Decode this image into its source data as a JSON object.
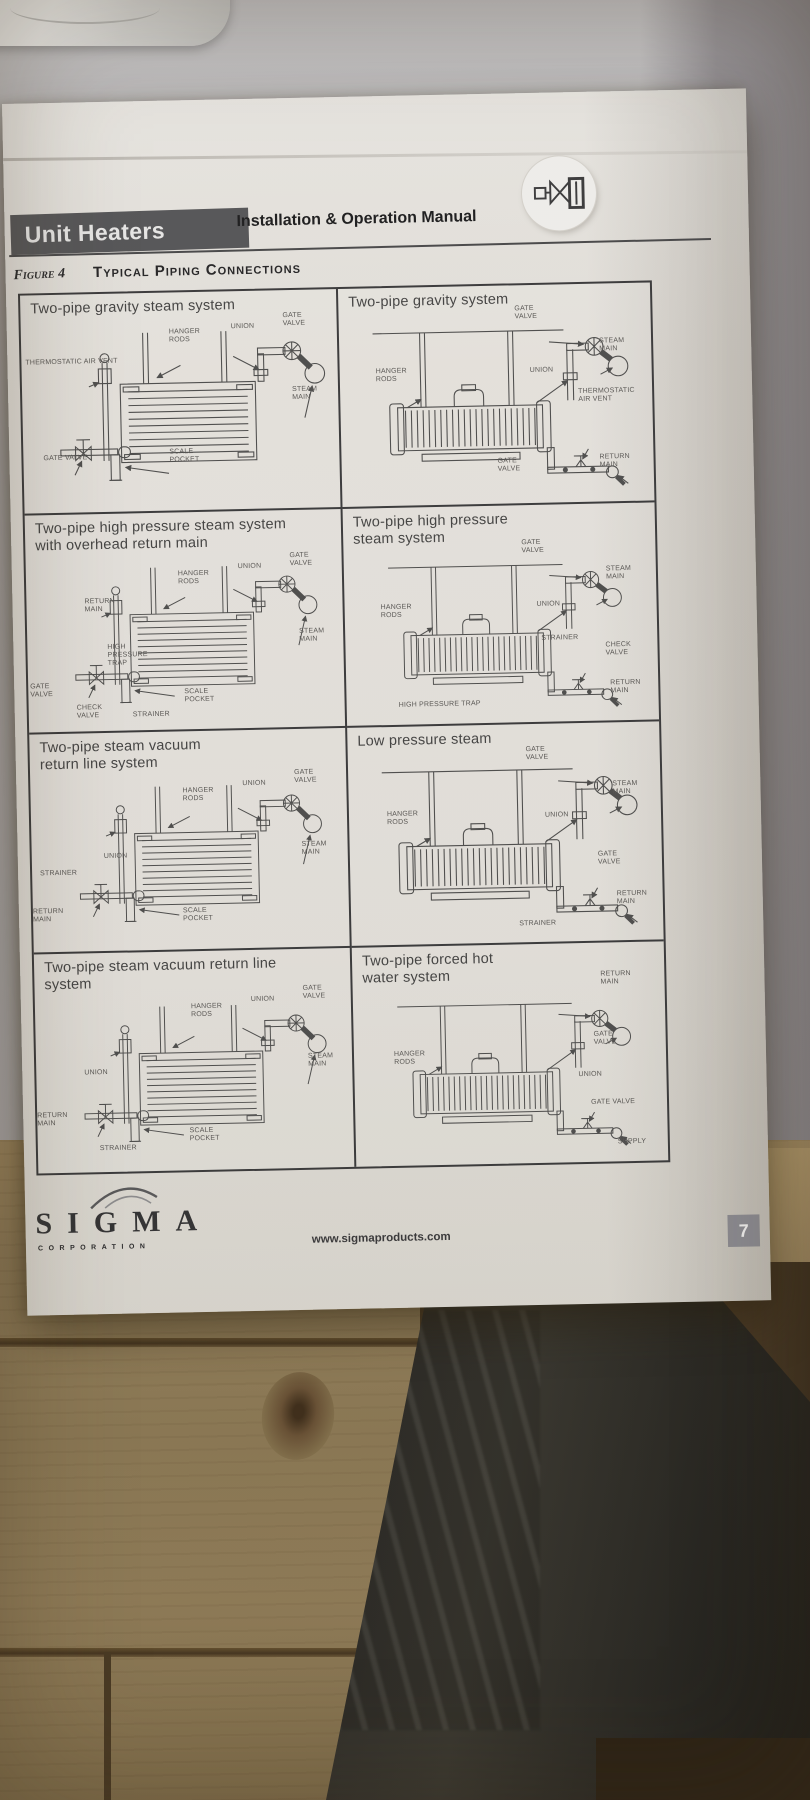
{
  "header": {
    "product_title": "Unit Heaters",
    "manual_title": "Installation & Operation Manual"
  },
  "figure": {
    "label": "Figure 4",
    "title": "Typical Piping Connections"
  },
  "panels": [
    {
      "title": "Two-pipe gravity steam system",
      "labels": [
        "HANGER RODS",
        "UNION",
        "GATE VALVE",
        "THERMOSTATIC AIR VENT",
        "STEAM MAIN",
        "GATE VALVE",
        "SCALE POCKET"
      ]
    },
    {
      "title": "Two-pipe gravity system",
      "labels": [
        "GATE VALVE",
        "STEAM MAIN",
        "HANGER RODS",
        "UNION",
        "THERMOSTATIC AIR VENT",
        "GATE VALVE",
        "RETURN MAIN"
      ]
    },
    {
      "title": "Two-pipe high pressure steam system with overhead return main",
      "labels": [
        "RETURN MAIN",
        "HANGER RODS",
        "UNION",
        "GATE VALVE",
        "STEAM MAIN",
        "HIGH PRESSURE TRAP",
        "GATE VALVE",
        "CHECK VALVE",
        "STRAINER",
        "SCALE POCKET"
      ]
    },
    {
      "title": "Two-pipe high pressure steam system",
      "labels": [
        "GATE VALVE",
        "STEAM MAIN",
        "HANGER RODS",
        "UNION",
        "STRAINER",
        "CHECK VALVE",
        "RETURN MAIN",
        "HIGH PRESSURE TRAP"
      ]
    },
    {
      "title": "Two-pipe steam vacuum return line system",
      "labels": [
        "HANGER RODS",
        "UNION",
        "GATE VALVE",
        "STEAM MAIN",
        "UNION",
        "STRAINER",
        "RETURN MAIN",
        "SCALE POCKET"
      ]
    },
    {
      "title": "Low pressure steam",
      "labels": [
        "GATE VALVE",
        "STEAM MAIN",
        "HANGER RODS",
        "UNION",
        "GATE VALVE",
        "STRAINER",
        "RETURN MAIN"
      ]
    },
    {
      "title": "Two-pipe steam vacuum return line system",
      "labels": [
        "HANGER RODS",
        "UNION",
        "GATE VALVE",
        "STEAM MAIN",
        "UNION",
        "RETURN MAIN",
        "STRAINER",
        "SCALE POCKET"
      ]
    },
    {
      "title": "Two-pipe forced hot water system",
      "labels": [
        "RETURN MAIN",
        "GATE VALVE",
        "HANGER RODS",
        "UNION",
        "GATE VALVE",
        "SUPPLY"
      ]
    }
  ],
  "footer": {
    "brand": "SIGMA",
    "brand_subtitle": "CORPORATION",
    "website": "www.sigmaproducts.com",
    "page_number": "7"
  },
  "colors": {
    "header_bar": "#57575a",
    "paper": "#e7e4df",
    "wood": "#8d7a5c",
    "shadow_band": "#97959a",
    "page_number_box": "#8d8d94",
    "diagram_stroke": "#4f4f4f"
  }
}
